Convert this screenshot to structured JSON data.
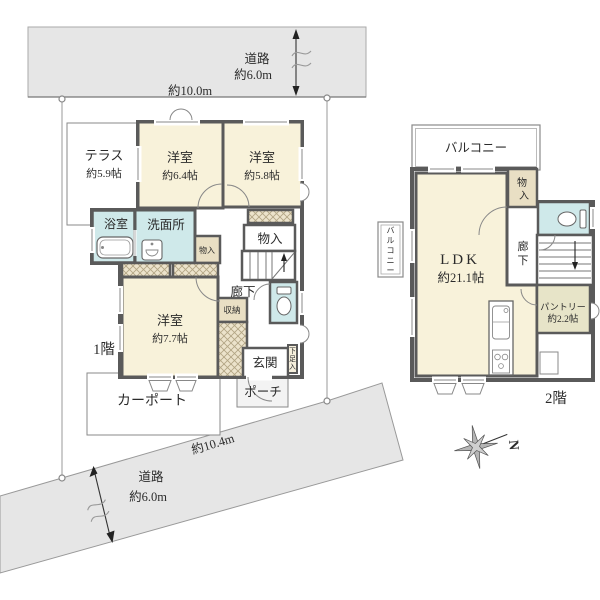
{
  "land": {
    "road_top": {
      "name": "道路",
      "width": "約6.0m",
      "frontage": "約10.0m"
    },
    "road_bottom": {
      "name": "道路",
      "width": "約6.0m",
      "frontage": "約10.4m"
    }
  },
  "floor1": {
    "label": "1階",
    "terrace": {
      "name": "テラス",
      "size": "約5.9帖"
    },
    "bedroom1": {
      "name": "洋室",
      "size": "約6.4帖"
    },
    "bedroom2": {
      "name": "洋室",
      "size": "約5.8帖"
    },
    "bedroom3": {
      "name": "洋室",
      "size": "約7.7帖"
    },
    "bath": "浴室",
    "washroom": "洗面所",
    "closet_small": "物入",
    "closet": "物入",
    "storage": "収納",
    "hall": "廊下",
    "entrance": "玄関",
    "shoe_closet": "下足入",
    "porch": "ポーチ",
    "carport": "カーポート"
  },
  "floor2": {
    "label": "2階",
    "balcony": "バルコニー",
    "balcony_side": "バルコニー",
    "ldk": {
      "name": "LDK",
      "size": "約21.1帖"
    },
    "closet": "物入",
    "hall": "廊下",
    "pantry": {
      "name": "パントリー",
      "size": "約2.2帖"
    }
  },
  "compass": {
    "north": "N"
  },
  "colors": {
    "wall": "#5a5a5a",
    "room_cream": "#f8f2da",
    "wet_blue": "#cfe9ea",
    "closet_tan": "#e9dfc4",
    "hatch_tan": "#ece3cb",
    "pantry_olive": "#e7e4c8",
    "road_gray": "#e6e6e6"
  }
}
